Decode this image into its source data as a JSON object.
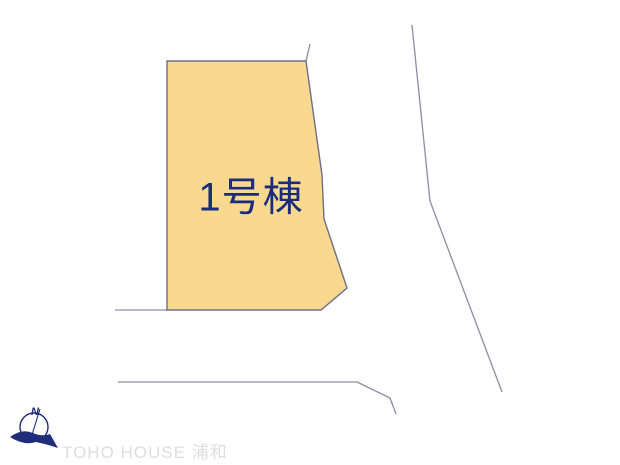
{
  "diagram": {
    "background_color": "#ffffff",
    "lot": {
      "label": "1号棟",
      "label_color": "#1c2c7c",
      "fill": "#F8D98F",
      "border_color": "#6e6e8a",
      "points": "167,61 306,61 322,175 324,219 347,288 321,310 167,310"
    },
    "boundary_lines": [
      {
        "name": "boundary-spur-top-right",
        "points": "310,44 306,61",
        "color": "#8d8da6"
      },
      {
        "name": "boundary-extension-west",
        "points": "115,310 167,310",
        "color": "#8d8da6"
      },
      {
        "name": "road-line-south",
        "points": "118,382 357,382 390,398 396,414",
        "color": "#8d8da6"
      },
      {
        "name": "road-line-east",
        "points": "412,25 427,172 430,201 502,392",
        "color": "#8d8da6"
      }
    ],
    "compass": {
      "north_label": "N",
      "color": "#1f2d7b"
    },
    "watermark": {
      "text": "TOHO HOUSE 浦和",
      "color": "#dedede"
    }
  }
}
